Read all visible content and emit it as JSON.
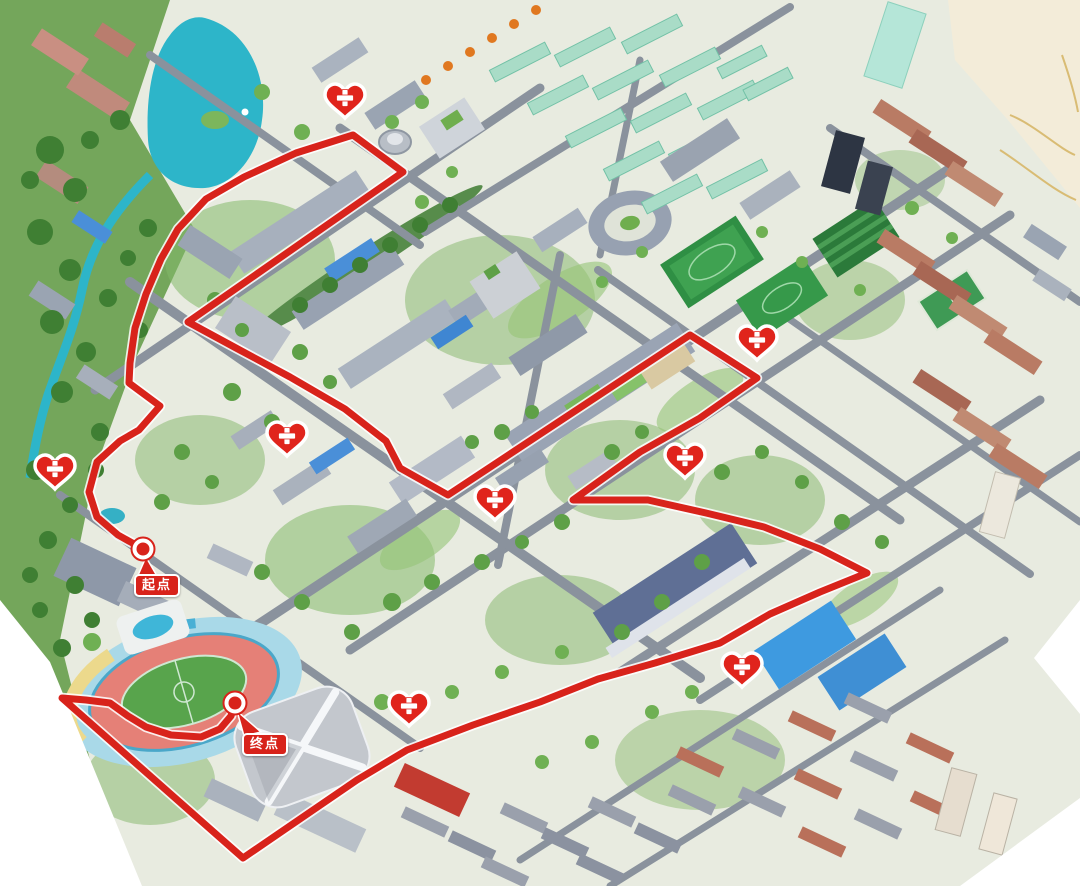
{
  "map": {
    "kind": "isometric-campus-route-map",
    "route": {
      "color": "#d8231b",
      "casing_color": "#ffffff",
      "stroke_width": 7,
      "points": [
        [
          143,
          549
        ],
        [
          118,
          535
        ],
        [
          97,
          517
        ],
        [
          89,
          492
        ],
        [
          97,
          462
        ],
        [
          120,
          441
        ],
        [
          139,
          430
        ],
        [
          160,
          406
        ],
        [
          129,
          383
        ],
        [
          130,
          363
        ],
        [
          135,
          328
        ],
        [
          146,
          294
        ],
        [
          161,
          259
        ],
        [
          178,
          229
        ],
        [
          206,
          199
        ],
        [
          244,
          177
        ],
        [
          296,
          153
        ],
        [
          353,
          135
        ],
        [
          403,
          172
        ],
        [
          188,
          322
        ],
        [
          236,
          348
        ],
        [
          290,
          377
        ],
        [
          345,
          409
        ],
        [
          386,
          441
        ],
        [
          400,
          468
        ],
        [
          448,
          495
        ],
        [
          690,
          335
        ],
        [
          757,
          378
        ],
        [
          700,
          418
        ],
        [
          640,
          452
        ],
        [
          573,
          500
        ],
        [
          648,
          500
        ],
        [
          706,
          513
        ],
        [
          764,
          527
        ],
        [
          820,
          549
        ],
        [
          867,
          573
        ],
        [
          820,
          592
        ],
        [
          770,
          614
        ],
        [
          720,
          643
        ],
        [
          655,
          663
        ],
        [
          598,
          679
        ],
        [
          540,
          702
        ],
        [
          473,
          725
        ],
        [
          407,
          750
        ],
        [
          357,
          780
        ],
        [
          300,
          819
        ],
        [
          243,
          858
        ],
        [
          62,
          698
        ],
        [
          86,
          700
        ],
        [
          110,
          703
        ],
        [
          128,
          716
        ],
        [
          146,
          727
        ],
        [
          171,
          735
        ],
        [
          201,
          737
        ],
        [
          220,
          729
        ],
        [
          231,
          716
        ],
        [
          234,
          706
        ]
      ]
    },
    "start_point": {
      "label": "起点",
      "dot_x": 143,
      "dot_y": 549,
      "box_x": 134,
      "box_y": 574
    },
    "finish_point": {
      "label": "终点",
      "dot_x": 235,
      "dot_y": 703,
      "box_x": 242,
      "box_y": 733
    },
    "aid_stations": {
      "icon": "heart-with-cross",
      "count": 8,
      "color": "#e0241c",
      "positions": [
        [
          345,
          103
        ],
        [
          757,
          345
        ],
        [
          287,
          441
        ],
        [
          55,
          474
        ],
        [
          495,
          505
        ],
        [
          685,
          463
        ],
        [
          742,
          672
        ],
        [
          409,
          711
        ]
      ]
    },
    "palette": {
      "label_red": "#d8231b",
      "marker_red": "#e0241c",
      "lake_teal": "#2db5c9",
      "dorm_mint": "#a9dcc7",
      "track_pink": "#e58077",
      "stadium_apron": "#a9d9e8",
      "field_green": "#58a44c",
      "road_gray": "#8a929d",
      "ground": "#e8ebe0",
      "offmap_beige": "#f3ecd9"
    }
  }
}
